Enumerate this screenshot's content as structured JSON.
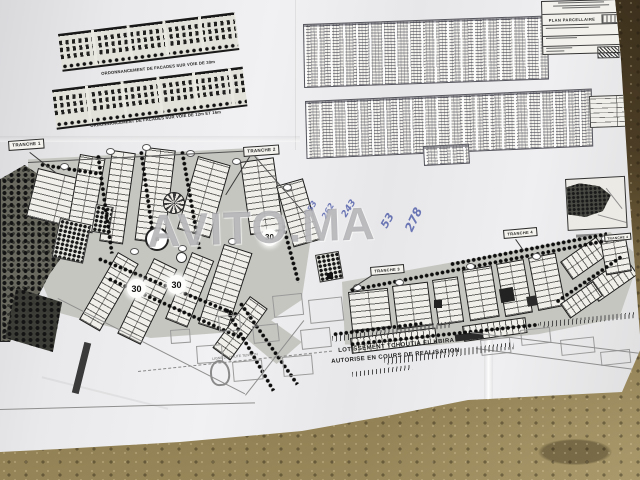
{
  "photo": {
    "watermark_text": "AVITO.MA",
    "paper_color": "#e9e9eb",
    "ground_dark": "#4b3d25",
    "ground_light": "#9a8a5c"
  },
  "facades": {
    "caption_voie_30": "ORDONNANCEMENT DE FACADES SUR VOIE DE 30m",
    "caption_voie_12_16": "ORDONNANCEMENT DE FACADES SUR VOIE DE 12m ET 16m"
  },
  "title_block": {
    "title": "PLAN PARCELLAIRE"
  },
  "plan": {
    "tranches": [
      {
        "label": "TRANCHE 1"
      },
      {
        "label": "TRANCHE 2"
      },
      {
        "label": "TRANCHE 3"
      },
      {
        "label": "TRANCHE 4"
      },
      {
        "label": "TRANCHE 4"
      }
    ],
    "road_width_badges": [
      "30",
      "30",
      "30"
    ],
    "main_label_line1": "LOTISSEMENT TCHOUTIA EL KBIRA",
    "main_label_line2": "AUTORISE EN COURS DE REALISATION",
    "power_line_label": "LIGNE DE HAUTE TENSION"
  },
  "annotations": {
    "pen_color": "#4456a6",
    "items": [
      {
        "text": "753"
      },
      {
        "text": "262"
      },
      {
        "text": "243"
      },
      {
        "text": "53"
      },
      {
        "text": "278"
      }
    ]
  }
}
